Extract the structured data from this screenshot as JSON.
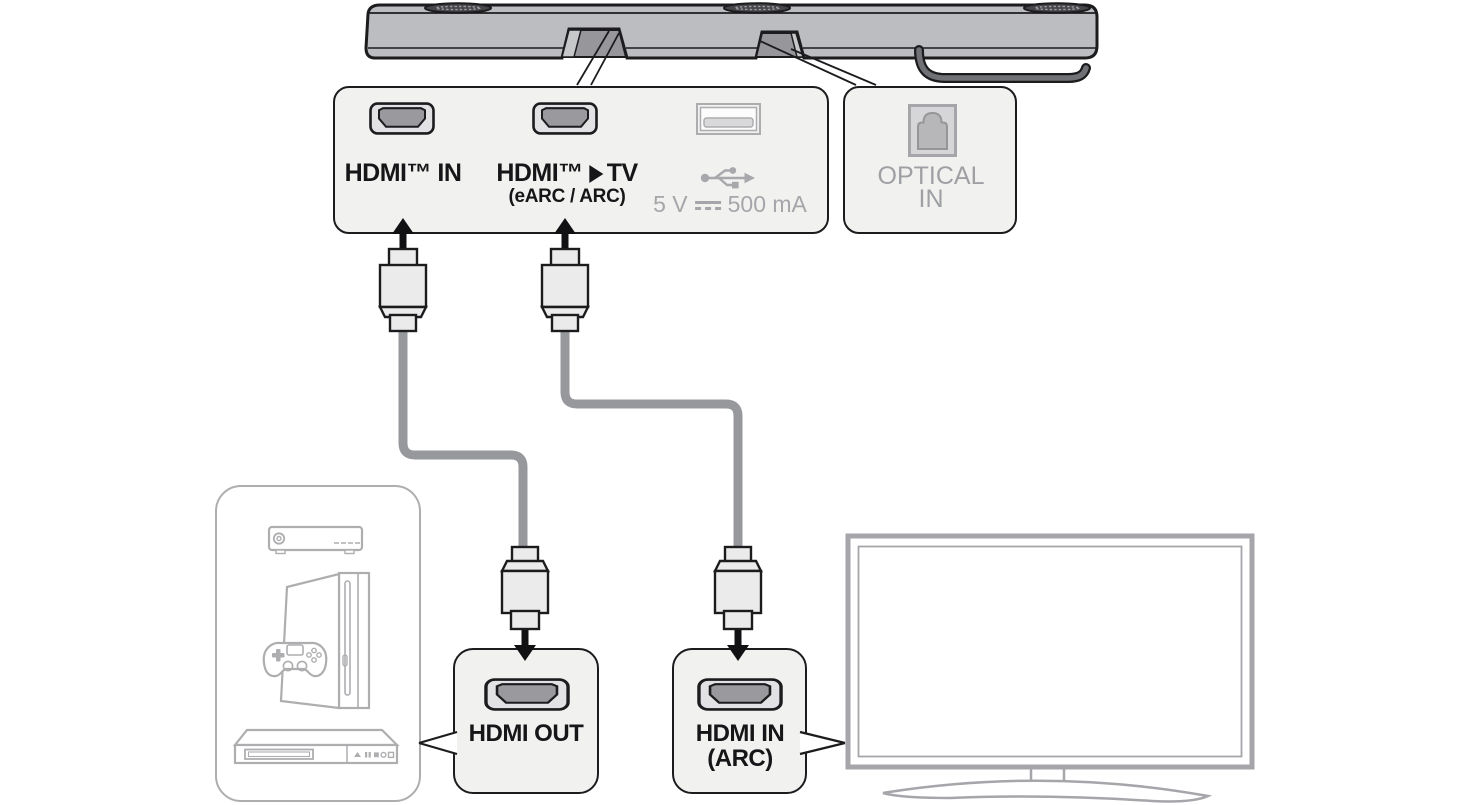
{
  "connection_panel": {
    "hdmi_in_label": "HDMI™ IN",
    "hdmi_tv_label_prefix": "HDMI™",
    "hdmi_tv_label_suffix": "TV",
    "hdmi_tv_sub_label": "(eARC / ARC)",
    "usb_power_volts": "5 V",
    "usb_power_current": "500 mA"
  },
  "optical_panel": {
    "label_line1": "OPTICAL",
    "label_line2": "IN"
  },
  "hdmi_out_port_box": {
    "label": "HDMI OUT"
  },
  "hdmi_in_arc_port_box": {
    "label_line1": "HDMI IN",
    "label_line2": "(ARC)"
  },
  "icons": [
    "soundbar",
    "hdmi-port-icon",
    "usb-port-icon",
    "usb-trident-icon",
    "optical-port-icon",
    "hdmi-plug-connector",
    "up-arrow-icon",
    "down-arrow-icon",
    "right-arrow-icon",
    "dc-symbol-icon",
    "set-top-box-icon",
    "game-console-icon",
    "gamepad-icon",
    "disc-player-icon",
    "tv-icon"
  ],
  "colors": {
    "outline": "#1c1c1e",
    "soundbar_fill": "#bcbdc0",
    "panel_fill": "#f1f1f0",
    "port_inner": "#9a9a9e",
    "muted": "#a6a6aa",
    "cable": "#97989b",
    "device_outline": "#aeaeb1"
  }
}
